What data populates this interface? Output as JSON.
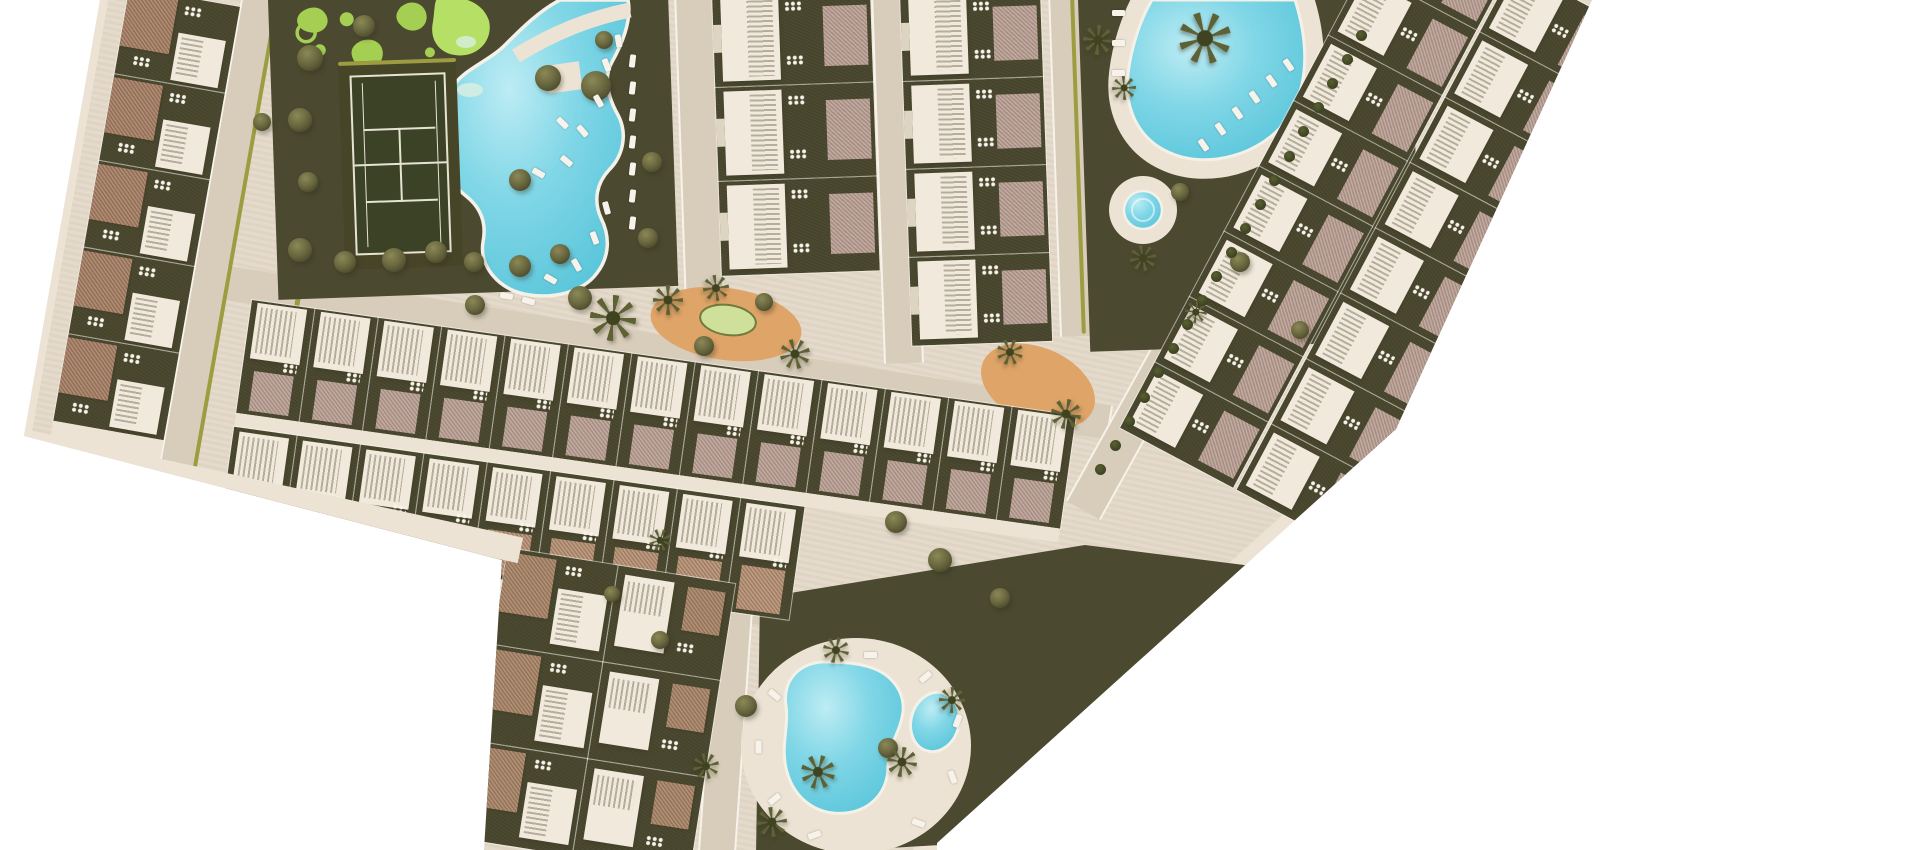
{
  "scene": {
    "type": "architectural-masterplan-render",
    "description": "Top-down 3D rendered site plan of a residential development with rows of townhouses, communal swimming pools, a tennis court, ornamental gardens, playgrounds and palm trees on beige hardscape, isolated on a white background."
  },
  "palette": {
    "background": "#ffffff",
    "plate": "#e4d9c9",
    "road": "#d8ccba",
    "sidewalk": "#ece3d4",
    "curb": "#f7f3ea",
    "garden": "#4b4930",
    "garden_dark": "#3f3e27",
    "hedge": "#9c9c40",
    "lawn": "#a4cf53",
    "lawn_bright": "#b5e065",
    "lawn_pale": "#cfe09a",
    "lawn_ring": "#6f7b3a",
    "tennis": "#3c4226",
    "tennis_line": "#e6e3d2",
    "water_light": "#bdecf4",
    "water": "#7fd6e6",
    "water_deep": "#55c3d9",
    "pool_rim": "#f4f1e8",
    "pool_step": "#d8efe2",
    "roof_terracotta": "#a0785d",
    "roof_brown": "#a27e60",
    "terrace_mauve": "#b1968a",
    "terrace_brick": "#ac8567",
    "building": "#f0e9dc",
    "building_shade": "#ddd4c2",
    "slat": "#b5ae9c",
    "tree": "#63613a",
    "tree_light": "#8b8957",
    "palm": "#5d6134",
    "sand": "#dfa467",
    "sand_light": "#eec695"
  },
  "housing": {
    "left_row_units": 5,
    "center_col1_units": 3,
    "center_col2_units": 4,
    "mid_row_upper_units": 13,
    "mid_row_lower_units": 9,
    "east_band_inner_units": 8,
    "east_band_outer_units": 8,
    "south_col_units": 3,
    "south_col_secondary_units": 3
  },
  "amenities": {
    "tennis_court": 1,
    "main_pool": 1,
    "north_pool": 1,
    "kids_pool": 1,
    "south_pool_basins": 2,
    "playgrounds": 2,
    "ornamental_garden": 1
  }
}
